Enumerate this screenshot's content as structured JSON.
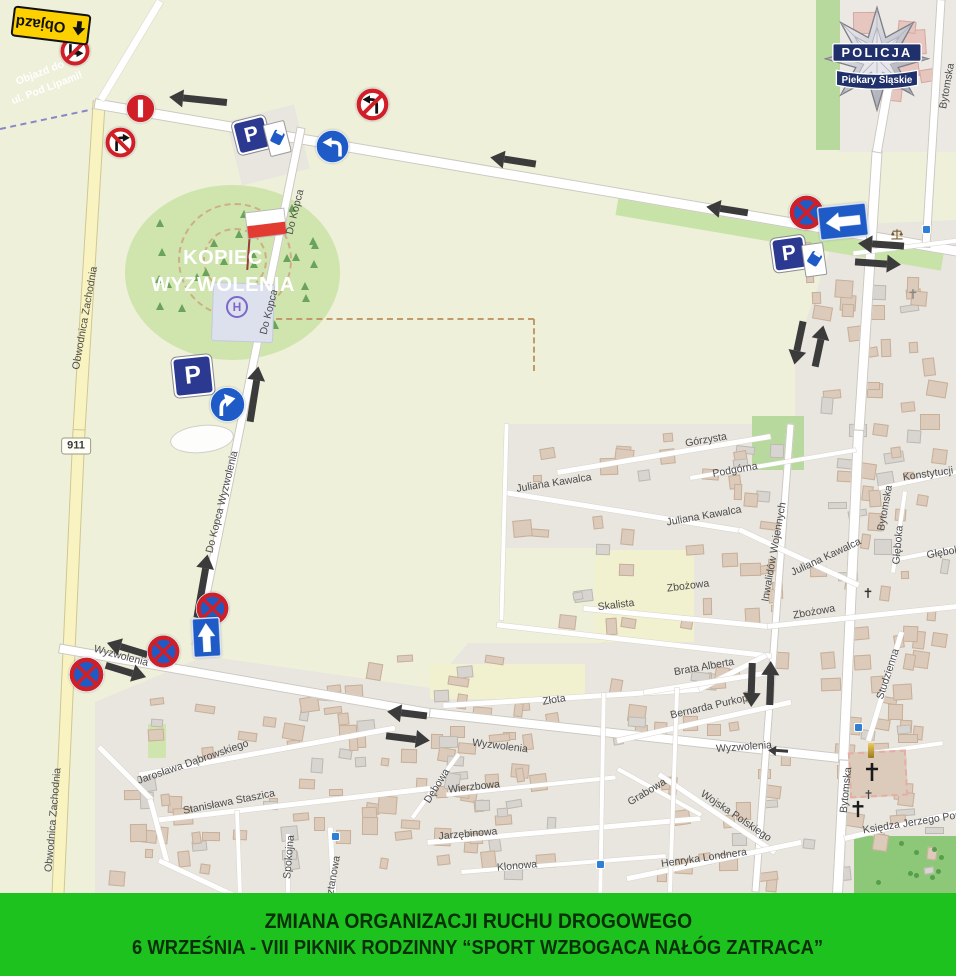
{
  "banner": {
    "line1": "ZMIANA ORGANIZACJI RUCHU DROGOWEGO",
    "line2": "6 WRZEŚNIA - VIII PIKNIK RODZINNY “SPORT WZBOGACA NAŁÓG ZATRACA”",
    "bg_color": "#1ec21e",
    "text_color": "#083008"
  },
  "police_badge": {
    "line1": "POLICJA",
    "line2": "Piekary Śląskie",
    "ribbon_color": "#20306b"
  },
  "kopiec": {
    "line1": "KOPIEC",
    "line2": "WYZWOLENIA"
  },
  "helipad_symbol": "H",
  "road_badge": "911",
  "detour_sign_label": "Objazd",
  "colors": {
    "sign_red": "#d01f26",
    "sign_blue": "#1e5bc6",
    "parking_navy": "#2b3990",
    "arrow_black": "#3b3b3b",
    "detour_yellow": "#fdd000"
  },
  "map_labels": [
    {
      "t": "Objazd do",
      "x": 40,
      "y": 73,
      "r": -21,
      "c": "#ffffff",
      "b": 1
    },
    {
      "t": "ul. Pod Lipami!",
      "x": 47,
      "y": 88,
      "r": -21,
      "c": "#ffffff",
      "b": 1
    },
    {
      "t": "Obwodnica Zachodnia",
      "x": 85,
      "y": 318,
      "r": -80
    },
    {
      "t": "Obwodnica Zachodnia",
      "x": 53,
      "y": 820,
      "r": -85
    },
    {
      "t": "Do Kopca",
      "x": 295,
      "y": 212,
      "r": -76
    },
    {
      "t": "Do Kopca",
      "x": 269,
      "y": 312,
      "r": -76
    },
    {
      "t": "Do Kopca Wyzwolenia",
      "x": 222,
      "y": 502,
      "r": -76
    },
    {
      "t": "Wyzwolenia",
      "x": 121,
      "y": 656,
      "r": 15
    },
    {
      "t": "Wyzwolenia",
      "x": 500,
      "y": 746,
      "r": 7
    },
    {
      "t": "Wyzwolenia",
      "x": 744,
      "y": 747,
      "r": -4
    },
    {
      "t": "Górzysta",
      "x": 706,
      "y": 440,
      "r": -10
    },
    {
      "t": "Podgórna",
      "x": 735,
      "y": 470,
      "r": -10
    },
    {
      "t": "Konstytucji",
      "x": 928,
      "y": 474,
      "r": -8
    },
    {
      "t": "Juliana Kawalca",
      "x": 554,
      "y": 483,
      "r": -9
    },
    {
      "t": "Juliana Kawalca",
      "x": 704,
      "y": 516,
      "r": -10
    },
    {
      "t": "Juliana Kawalca",
      "x": 826,
      "y": 557,
      "r": -25
    },
    {
      "t": "Zbożowa",
      "x": 688,
      "y": 586,
      "r": -7
    },
    {
      "t": "Zbożowa",
      "x": 814,
      "y": 612,
      "r": -10
    },
    {
      "t": "Skalista",
      "x": 616,
      "y": 605,
      "r": -7
    },
    {
      "t": "Głęboka",
      "x": 898,
      "y": 545,
      "r": -85
    },
    {
      "t": "Głęboka",
      "x": 946,
      "y": 552,
      "r": -10
    },
    {
      "t": "Bytomska",
      "x": 947,
      "y": 86,
      "r": -80
    },
    {
      "t": "Bytomska",
      "x": 885,
      "y": 508,
      "r": -80
    },
    {
      "t": "Bytomska",
      "x": 846,
      "y": 790,
      "r": -84
    },
    {
      "t": "Inwalidów Wojennych",
      "x": 774,
      "y": 552,
      "r": -80
    },
    {
      "t": "Studzienna",
      "x": 888,
      "y": 674,
      "r": -72
    },
    {
      "t": "Brata Alberta",
      "x": 704,
      "y": 667,
      "r": -10
    },
    {
      "t": "Bernarda Purkopa",
      "x": 712,
      "y": 706,
      "r": -13
    },
    {
      "t": "Złota",
      "x": 554,
      "y": 700,
      "r": -9
    },
    {
      "t": "Grabowa",
      "x": 647,
      "y": 792,
      "r": -31
    },
    {
      "t": "Wojska Polskiego",
      "x": 736,
      "y": 816,
      "r": 34
    },
    {
      "t": "Henryka Londnera",
      "x": 704,
      "y": 858,
      "r": -8
    },
    {
      "t": "Księdza Jerzego Popie",
      "x": 916,
      "y": 822,
      "r": -9
    },
    {
      "t": "Wierzbowa",
      "x": 474,
      "y": 787,
      "r": -6
    },
    {
      "t": "Dębowa",
      "x": 437,
      "y": 786,
      "r": -58
    },
    {
      "t": "Jarzębinowa",
      "x": 468,
      "y": 834,
      "r": -5
    },
    {
      "t": "Klonowa",
      "x": 517,
      "y": 866,
      "r": -5
    },
    {
      "t": "Jarosława Dąbrowskiego",
      "x": 193,
      "y": 762,
      "r": -19
    },
    {
      "t": "Stanisława Staszica",
      "x": 229,
      "y": 802,
      "r": -11
    },
    {
      "t": "Spokojna",
      "x": 289,
      "y": 857,
      "r": -85
    },
    {
      "t": "Kasztanowa",
      "x": 332,
      "y": 884,
      "r": -80
    }
  ],
  "traffic_signs": [
    {
      "type": "no-turn-bent",
      "x": 75,
      "y": 51,
      "s": 32
    },
    {
      "type": "no-entry-bar",
      "x": 140,
      "y": 108,
      "s": 31
    },
    {
      "type": "no-right-turn",
      "x": 120,
      "y": 142,
      "s": 33
    },
    {
      "type": "parking-meter",
      "x": 264,
      "y": 137,
      "rot": -14
    },
    {
      "type": "mandatory-left",
      "x": 332,
      "y": 146,
      "s": 35
    },
    {
      "type": "no-left-turn",
      "x": 372,
      "y": 104,
      "s": 35
    },
    {
      "type": "no-stopping",
      "x": 806,
      "y": 212,
      "s": 37
    },
    {
      "type": "one-way-left",
      "x": 843,
      "y": 221,
      "rot": -6
    },
    {
      "type": "parking-meter",
      "x": 801,
      "y": 257,
      "rot": -8
    },
    {
      "type": "parking",
      "x": 193,
      "y": 376,
      "s": 40,
      "rot": -6
    },
    {
      "type": "mandatory-right",
      "x": 227,
      "y": 404,
      "s": 37
    },
    {
      "type": "no-stopping",
      "x": 86,
      "y": 674,
      "s": 37
    },
    {
      "type": "no-stopping",
      "x": 163,
      "y": 651,
      "s": 35
    },
    {
      "type": "no-stopping",
      "x": 212,
      "y": 608,
      "s": 35
    },
    {
      "type": "one-way-up",
      "x": 206,
      "y": 637,
      "rot": -3
    }
  ],
  "flow_arrows": [
    {
      "x": 198,
      "y": 100,
      "len": 58,
      "rot": 186
    },
    {
      "x": 513,
      "y": 161,
      "len": 46,
      "rot": 189
    },
    {
      "x": 727,
      "y": 210,
      "len": 42,
      "rot": 189
    },
    {
      "x": 881,
      "y": 245,
      "len": 46,
      "rot": 184
    },
    {
      "x": 878,
      "y": 263,
      "len": 46,
      "rot": 4
    },
    {
      "x": 799,
      "y": 343,
      "len": 44,
      "rot": 102
    },
    {
      "x": 819,
      "y": 346,
      "len": 42,
      "rot": 282
    },
    {
      "x": 254,
      "y": 394,
      "len": 56,
      "rot": 279
    },
    {
      "x": 202,
      "y": 586,
      "len": 64,
      "rot": 280
    },
    {
      "x": 127,
      "y": 649,
      "len": 42,
      "rot": 197
    },
    {
      "x": 126,
      "y": 671,
      "len": 42,
      "rot": 17
    },
    {
      "x": 407,
      "y": 714,
      "len": 40,
      "rot": 187
    },
    {
      "x": 408,
      "y": 738,
      "len": 44,
      "rot": 7
    },
    {
      "x": 752,
      "y": 685,
      "len": 44,
      "rot": 92
    },
    {
      "x": 770,
      "y": 683,
      "len": 44,
      "rot": 272
    },
    {
      "x": 778,
      "y": 751,
      "len": 20,
      "rot": 184,
      "thin": 1
    }
  ],
  "map_icons": [
    {
      "type": "bus-stop",
      "x": 858,
      "y": 727
    },
    {
      "type": "bus-stop",
      "x": 600,
      "y": 864
    },
    {
      "type": "bus-stop",
      "x": 335,
      "y": 836
    },
    {
      "type": "bus-stop",
      "x": 926,
      "y": 229
    },
    {
      "type": "cross",
      "x": 872,
      "y": 772,
      "s": 22,
      "c": "#1a1a1a"
    },
    {
      "type": "cross",
      "x": 858,
      "y": 809,
      "s": 20,
      "c": "#1a1a1a"
    },
    {
      "type": "cross",
      "x": 868,
      "y": 792,
      "s": 11,
      "c": "#444444"
    },
    {
      "type": "cross",
      "x": 868,
      "y": 592,
      "s": 12,
      "c": "#333333"
    },
    {
      "type": "cross",
      "x": 913,
      "y": 293,
      "s": 12,
      "c": "#888888"
    },
    {
      "type": "scales",
      "x": 897,
      "y": 234,
      "s": 14
    },
    {
      "type": "monument",
      "x": 871,
      "y": 751
    }
  ]
}
